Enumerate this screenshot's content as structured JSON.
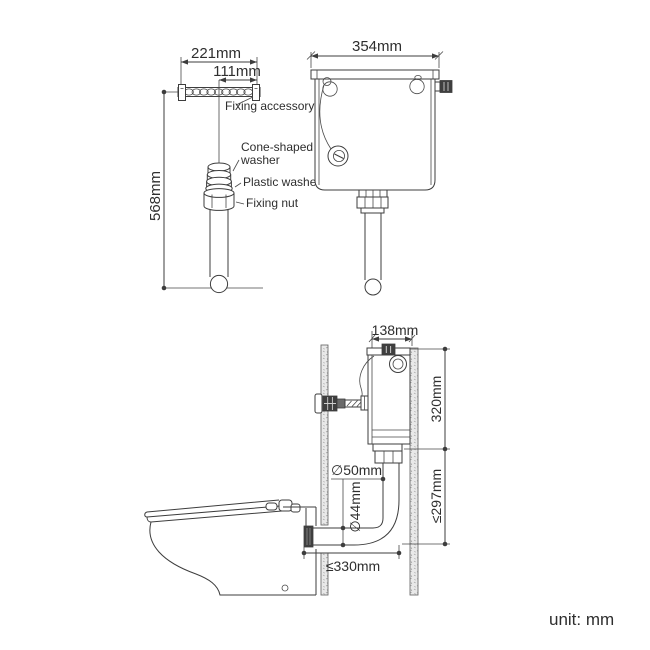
{
  "meta": {
    "unit_note": "unit: mm"
  },
  "colors": {
    "line": "#3d3d3d",
    "text": "#2e2e2e",
    "wall_fill": "#e9e9e9",
    "dark_fill": "#3f3f3f",
    "background": "#ffffff"
  },
  "fixing_kit_view": {
    "dim_strip_width": "221mm",
    "dim_strip_half_width": "111mm",
    "dim_pipe_length": "568mm",
    "label_fixing_accessory": "Fixing accessory",
    "label_cone_washer_line1": "Cone-shaped",
    "label_cone_washer_line2": "washer",
    "label_plastic_washer": "Plastic washer",
    "label_fixing_nut": "Fixing nut"
  },
  "cistern_front_view": {
    "dim_width": "354mm"
  },
  "installation_view": {
    "dim_cistern_depth": "138mm",
    "dim_cistern_height": "320mm",
    "dim_flush_pipe_drop": "≤297mm",
    "dim_flush_pipe_diameter": "∅50mm",
    "dim_inlet_diameter": "∅44mm",
    "dim_pan_setout": "≤330mm"
  }
}
